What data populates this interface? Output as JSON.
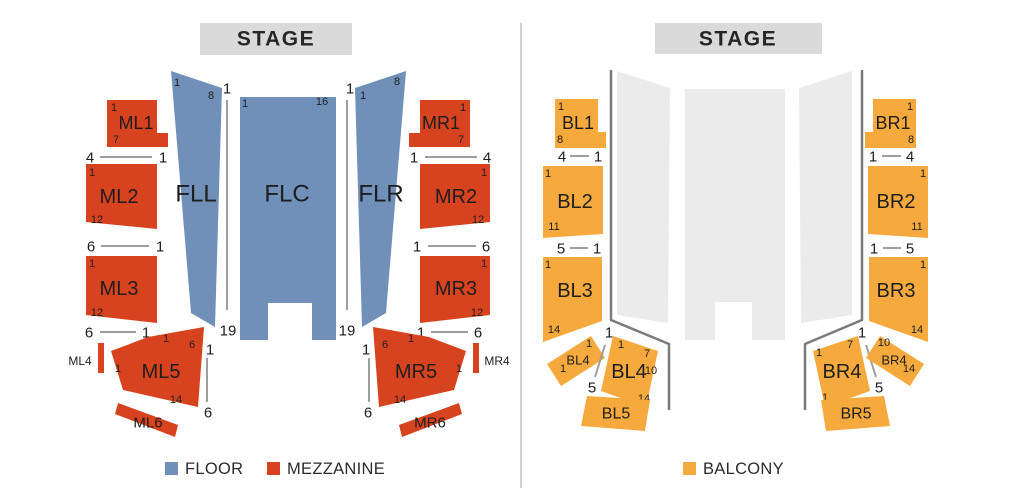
{
  "colors": {
    "floor": "#7090B9",
    "mezzanine": "#D8431F",
    "balcony": "#F6A93C",
    "ghost": "#EBEBEB",
    "stage_bg": "#DADADA"
  },
  "left_chart": {
    "stage_label": "STAGE",
    "floor": {
      "fll": {
        "label": "FLL",
        "top_left": "1",
        "top_right": "8"
      },
      "flc": {
        "label": "FLC",
        "top_left": "1",
        "top_right": "16"
      },
      "flr": {
        "label": "FLR",
        "top_left": "1",
        "top_right": "8"
      },
      "aisle_left": {
        "top": "1",
        "bottom": "19"
      },
      "aisle_right": {
        "top": "1",
        "bottom": "19"
      }
    },
    "mezzanine": {
      "ml1": {
        "label": "ML1",
        "row_start": "1",
        "row_end": "7"
      },
      "ml1_seats": {
        "left": "4",
        "right": "1"
      },
      "ml2": {
        "label": "ML2",
        "row_start": "1",
        "row_end": "12"
      },
      "ml2_seats": {
        "left": "6",
        "right": "1"
      },
      "ml3": {
        "label": "ML3",
        "row_start": "1",
        "row_end": "12"
      },
      "ml3_seats": {
        "left": "6",
        "right": "1"
      },
      "ml4": {
        "label": "ML4"
      },
      "ml5": {
        "label": "ML5",
        "top_row": "1",
        "top_seat": "6",
        "side_row": "1",
        "bottom_row": "14"
      },
      "ml5_aisle": {
        "top": "1",
        "bottom": "6"
      },
      "ml6": {
        "label": "ML6"
      },
      "mr1": {
        "label": "MR1",
        "row_start": "1",
        "row_end": "7"
      },
      "mr1_seats": {
        "left": "1",
        "right": "4"
      },
      "mr2": {
        "label": "MR2",
        "row_start": "1",
        "row_end": "12"
      },
      "mr2_seats": {
        "left": "1",
        "right": "6"
      },
      "mr3": {
        "label": "MR3",
        "row_start": "1",
        "row_end": "12"
      },
      "mr3_seats": {
        "left": "1",
        "right": "6"
      },
      "mr4": {
        "label": "MR4"
      },
      "mr5": {
        "label": "MR5",
        "top_seat": "6",
        "top_row": "1",
        "side_row": "1",
        "bottom_row": "14"
      },
      "mr5_aisle": {
        "top": "1",
        "bottom": "6"
      },
      "mr6": {
        "label": "MR6"
      }
    },
    "legend": {
      "floor": "FLOOR",
      "mezzanine": "MEZZANINE"
    }
  },
  "right_chart": {
    "stage_label": "STAGE",
    "balcony": {
      "bl1": {
        "label": "BL1",
        "row_start": "1",
        "row_end": "8"
      },
      "bl1_seats": {
        "left": "4",
        "right": "1"
      },
      "bl2": {
        "label": "BL2",
        "row_start": "1",
        "row_end": "11"
      },
      "bl2_seats": {
        "left": "5",
        "right": "1"
      },
      "bl3": {
        "label": "BL3",
        "row_start": "1",
        "row_end": "14"
      },
      "bl4_small": {
        "label": "BL4",
        "n_top": "1",
        "n_side": "1"
      },
      "bl4_aisle": {
        "top": "1",
        "bottom": "5"
      },
      "bl4": {
        "label": "BL4",
        "n1": "1",
        "n2": "7",
        "n3": "10",
        "n4": "14"
      },
      "bl5": {
        "label": "BL5"
      },
      "br1": {
        "label": "BR1",
        "row_start": "1",
        "row_end": "8"
      },
      "br1_seats": {
        "left": "1",
        "right": "4"
      },
      "br2": {
        "label": "BR2",
        "row_start": "1",
        "row_end": "11"
      },
      "br2_seats": {
        "left": "1",
        "right": "5"
      },
      "br3": {
        "label": "BR3",
        "row_start": "1",
        "row_end": "14"
      },
      "br4": {
        "label": "BR4",
        "n1": "1",
        "n2": "7",
        "n3": "1"
      },
      "br4_aisle": {
        "top": "1",
        "bottom": "5"
      },
      "br4_small": {
        "label": "BR4",
        "n_top": "10",
        "n_side": "14"
      },
      "br5": {
        "label": "BR5"
      }
    },
    "legend": {
      "balcony": "BALCONY"
    }
  }
}
